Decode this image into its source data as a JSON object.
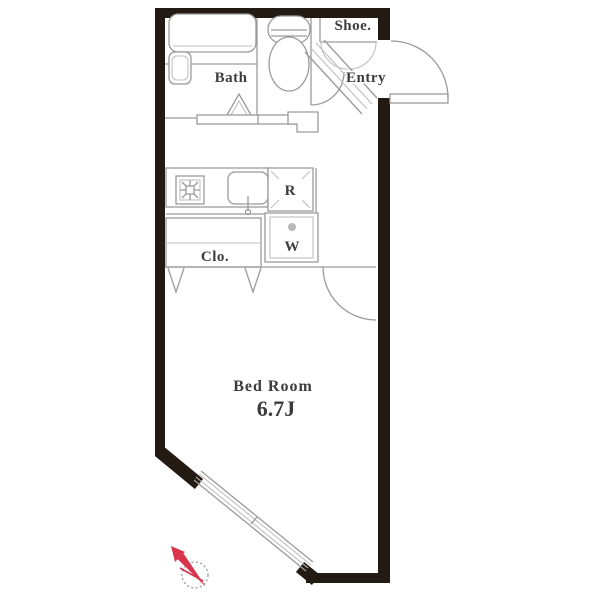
{
  "plan": {
    "title": "studio-apartment-floor-plan",
    "rooms": {
      "bath": {
        "label": "Bath"
      },
      "shoe": {
        "label": "Shoe."
      },
      "entry": {
        "label": "Entry"
      },
      "refrigerator": {
        "label": "R"
      },
      "washer": {
        "label": "W"
      },
      "closet": {
        "label": "Clo."
      },
      "bedroom": {
        "label": "Bed Room",
        "size": "6.7J"
      }
    },
    "icons": [
      "bathtub-icon",
      "washbasin-icon",
      "toilet-icon",
      "stove-icon",
      "kitchen-sink-icon",
      "refrigerator-corner-marks",
      "washer-pan-icon",
      "folding-door-icon",
      "door-swing-arc",
      "window-band",
      "compass-north-icon"
    ],
    "colors": {
      "wall": "#241a14",
      "line": "#9a9a9a",
      "line_light": "#c0bfbf",
      "text": "#3c3c3c",
      "accent_red": "#d8344d",
      "background": "#ffffff"
    }
  }
}
